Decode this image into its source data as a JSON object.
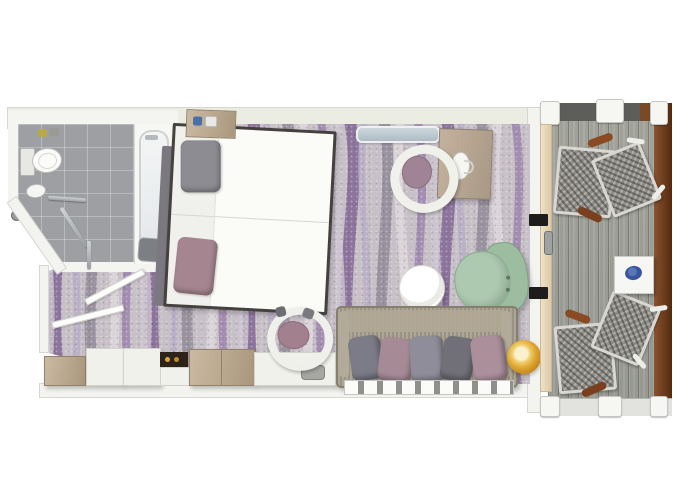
{
  "plan": {
    "title": "Stateroom floor plan with veranda",
    "rooms": {
      "bathroom": {
        "label": "Bathroom"
      },
      "cabin": {
        "label": "Bedroom and sitting area"
      },
      "balcony": {
        "label": "Private veranda"
      }
    },
    "colors": {
      "carpet_base": "#c7c0c7",
      "carpet_purple": "#7d6192",
      "carpet_lavender": "#b9aec6",
      "carpet_gray": "#8d8795",
      "bathroom_tile": "#9d9fa3",
      "deck_plank": "#a4a59f",
      "wood_cabinet": "#b9a88e",
      "sofa_fabric": "#a49c8b",
      "armchair_green": "#abc7ad",
      "pillow_gray": "#8d8c92",
      "pillow_mauve": "#a5858f",
      "stool_gold": "#dda42f",
      "bowl_blue": "#3a55a0",
      "railing_brown": "#7a4a28",
      "curtain_cream": "#e8d9ba"
    }
  },
  "tooltips": {
    "bathroom_floor": "Bathroom tiled floor",
    "toilet": "Toilet",
    "washbasin": "Washbasin",
    "bathtub": "Bathtub",
    "shower": "Shower head",
    "shower_seat": "Shower seat",
    "grab_bar": "Grab bar",
    "bathroom_door": "Bathroom door",
    "entrance_door": "Entrance door",
    "carpet": "Patterned carpet",
    "bed": "Double bed",
    "headboard": "Headboard",
    "nightstand": "Nightstand",
    "wardrobe": "Wardrobe cabinet",
    "cabinet": "Storage cabinet",
    "minibar": "Minibar niche",
    "vanity": "Vanity unit",
    "vanity_chair": "Vanity chair",
    "mirror_shelf": "Mirror shelf",
    "desk": "Writing desk",
    "desk_chair": "Desk chair",
    "round_table": "Round coffee table",
    "armchair": "Armchair",
    "sofa": "Sofa with cushions",
    "stool": "Gold pouf",
    "vent": "Floor vent",
    "partition_wall": "Cabin outer wall",
    "curtain": "Curtain",
    "balcony_door_frame": "Balcony door frame",
    "door_handle": "Balcony door handle",
    "deck": "Veranda deck",
    "lounge_chair": "Deck chair",
    "side_table": "Balcony side table",
    "bowl": "Decorative bowl",
    "railing": "Veranda railing"
  }
}
